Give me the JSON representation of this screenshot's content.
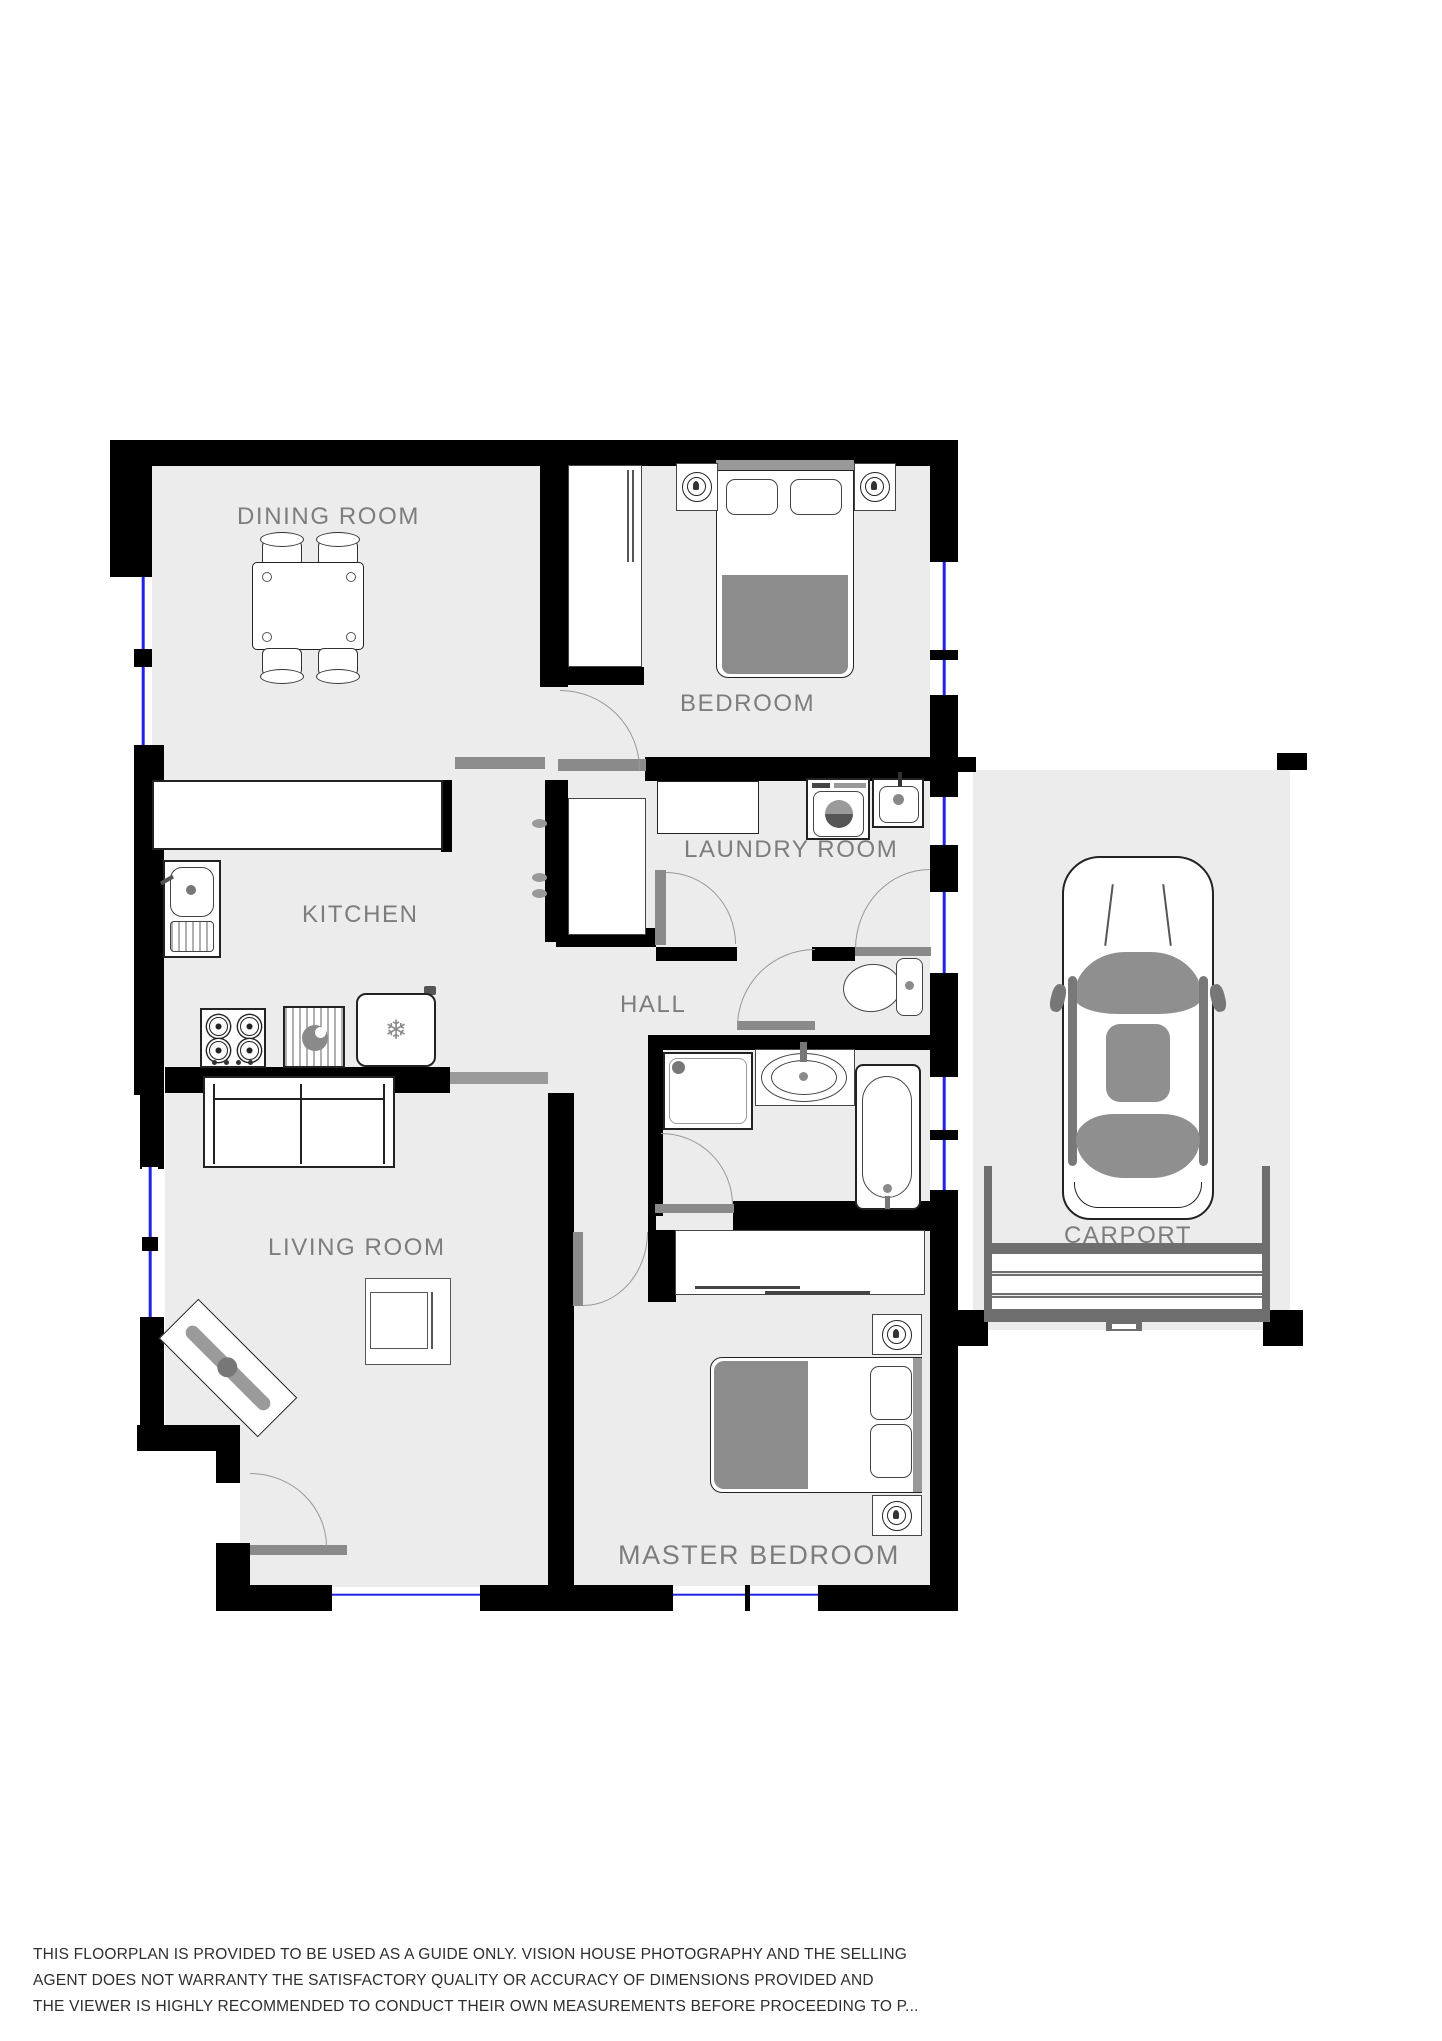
{
  "rooms": {
    "dining": {
      "label": "DINING ROOM"
    },
    "bedroom": {
      "label": "BEDROOM"
    },
    "kitchen": {
      "label": "KITCHEN"
    },
    "laundry": {
      "label": "LAUNDRY ROOM"
    },
    "hall": {
      "label": "HALL"
    },
    "living": {
      "label": "LIVING ROOM"
    },
    "master": {
      "label": "MASTER BEDROOM"
    },
    "carport": {
      "label": "CARPORT"
    }
  },
  "icons": {
    "snowflake": "❄"
  },
  "colors": {
    "wall": "#000000",
    "floor": "#ececec",
    "window": "#2323e6",
    "label": "#7d7d7d",
    "door": "#8a8a8a",
    "soft": "#8c8c8c",
    "text": "#2e2e2e",
    "frame": "#6e6e6e"
  },
  "disclaimer": {
    "line1": "THIS FLOORPLAN IS PROVIDED TO BE USED AS A GUIDE ONLY. VISION HOUSE PHOTOGRAPHY AND THE SELLING",
    "line2": "AGENT DOES NOT WARRANTY THE SATISFACTORY QUALITY OR ACCURACY OF DIMENSIONS PROVIDED AND",
    "line3": "THE VIEWER IS HIGHLY RECOMMENDED TO CONDUCT THEIR OWN MEASUREMENTS BEFORE PROCEEDING TO P..."
  }
}
